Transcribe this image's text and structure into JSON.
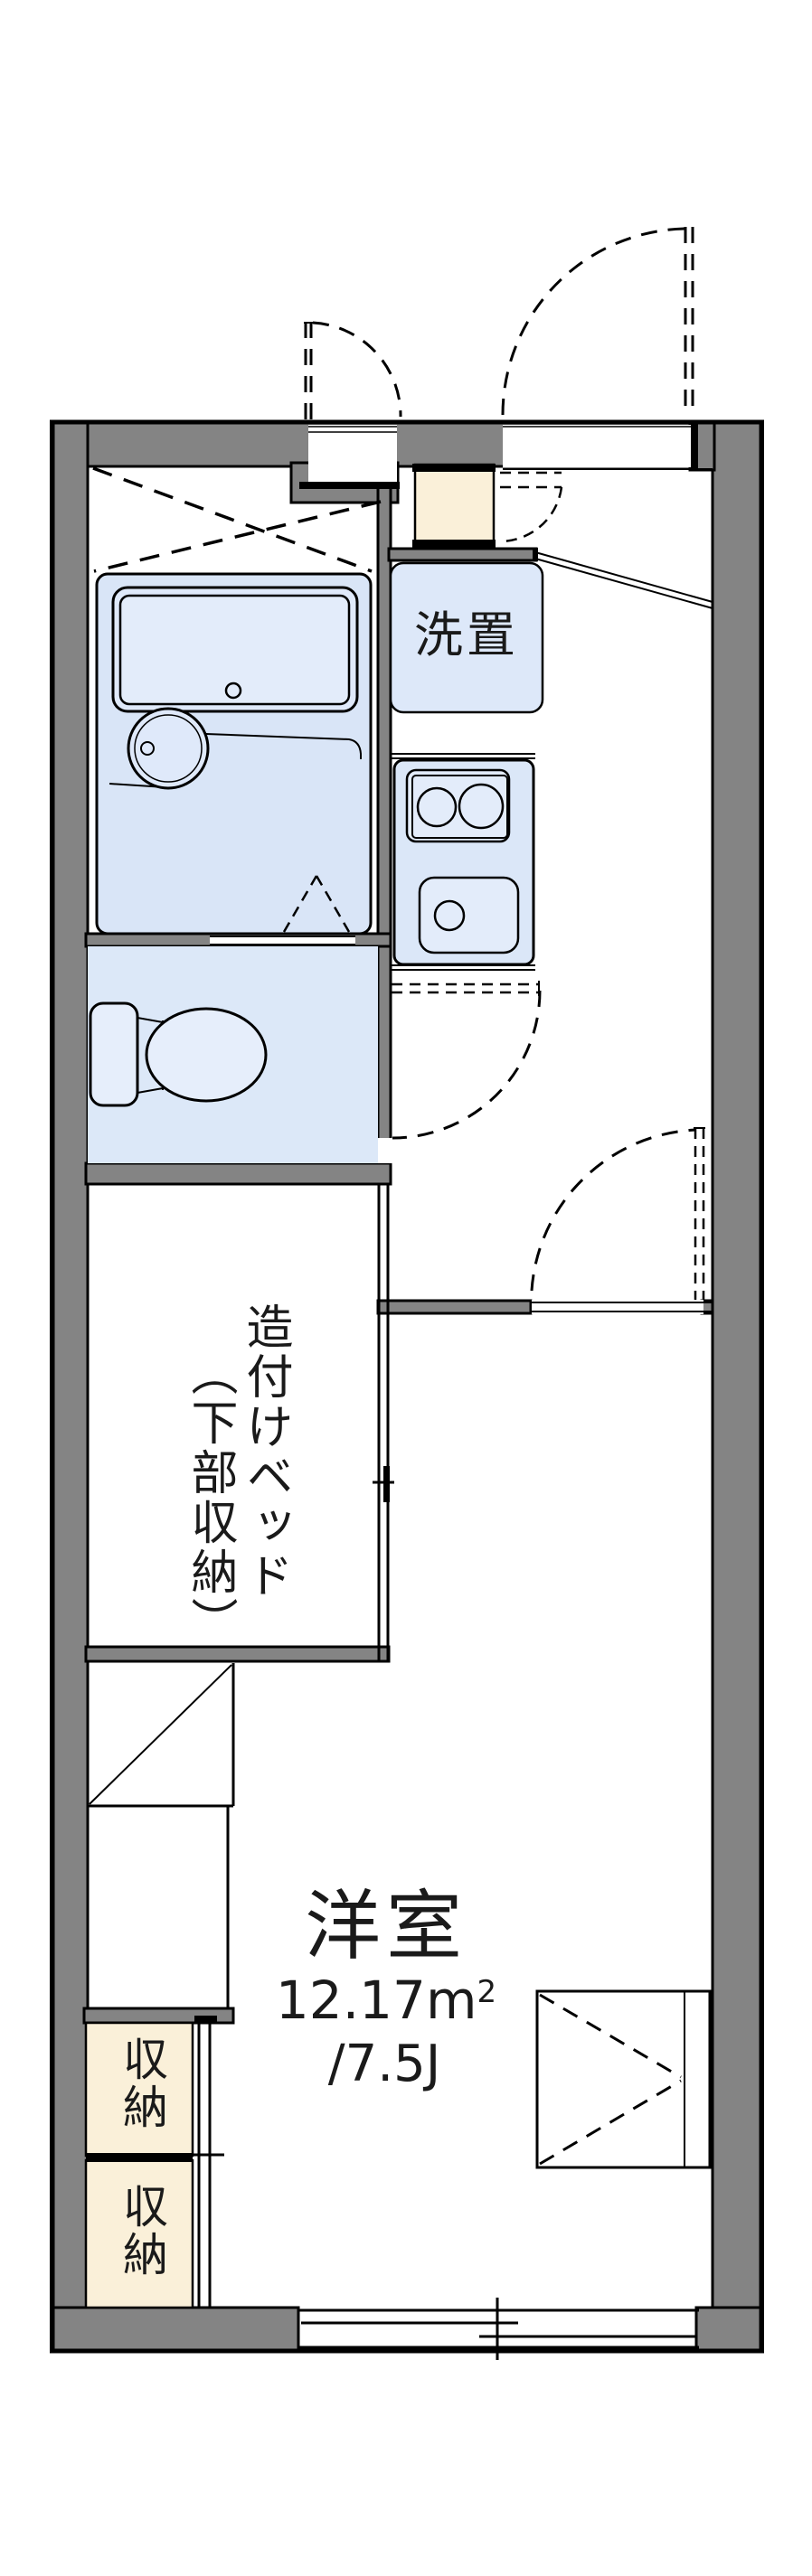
{
  "plan": {
    "labels": {
      "washer": "洗置",
      "bed_column_right": "造付けベッド",
      "bed_column_left": "（下部収納）",
      "room_name": "洋室",
      "room_area": "12.17m",
      "room_area_sup": "2",
      "room_tatami": "/7.5J",
      "storage_upper": "収納",
      "storage_lower": "収納"
    },
    "colors": {
      "wall_gray": "#848484",
      "outline_black": "#000000",
      "bathroom_fill": "#d9e5f7",
      "toilet_fill": "#dce8f8",
      "fixture_fill": "#e3ecfa",
      "washer_fill": "#dde8f9",
      "kitchen_fill": "#dbe7f8",
      "storage_cream": "#faf0d9",
      "background": "#ffffff"
    }
  }
}
